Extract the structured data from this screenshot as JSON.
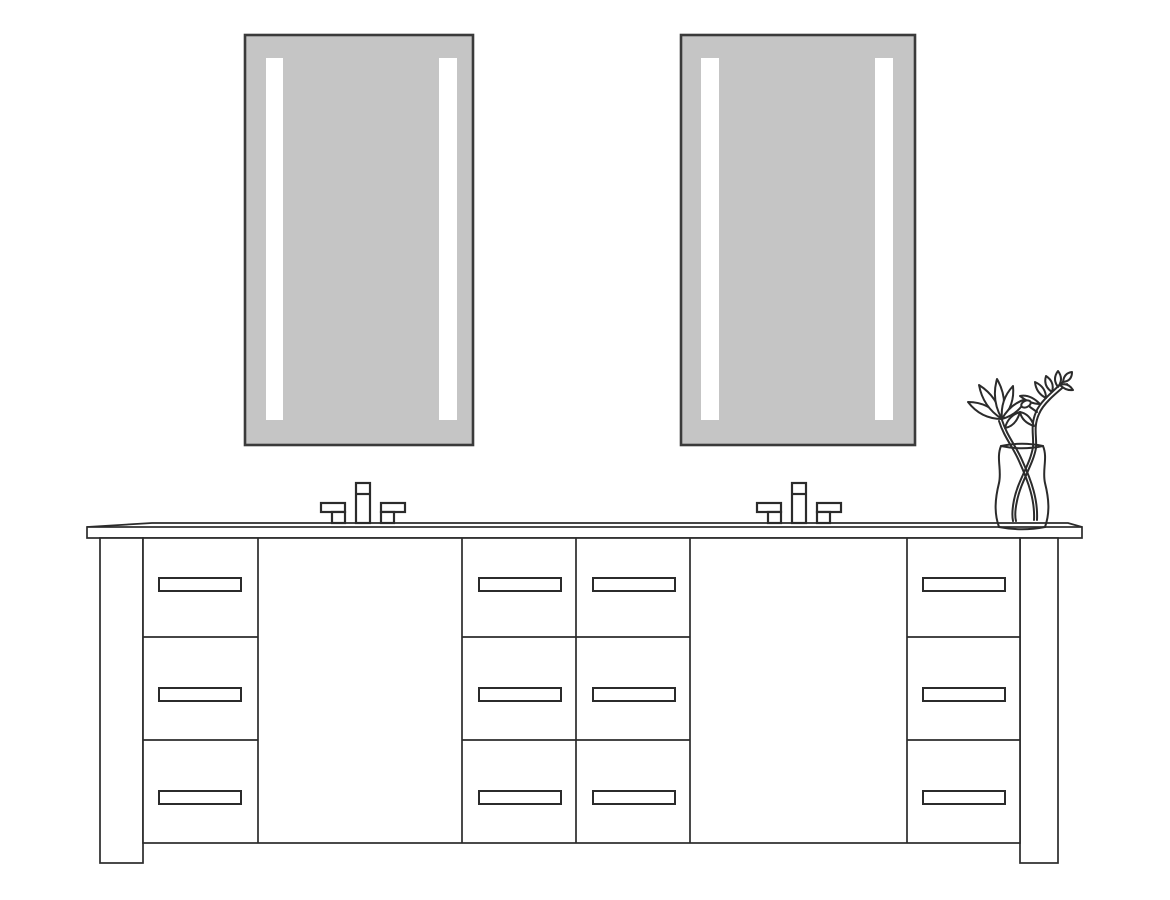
{
  "meta": {
    "title": "Line illustration of a double-sink bathroom vanity with two lighted LED mirrors, two widespread faucets and a flower vase"
  },
  "colors": {
    "background": "#ffffff",
    "line": "#2b2b2b",
    "mirror_fill": "#c5c5c5",
    "mirror_border": "#3a3a3a",
    "led_strip": "#ffffff"
  },
  "scene": {
    "mirrors": {
      "count": 2,
      "led_strips_per_mirror": 2,
      "style": "rectangular, frameless, vertical LED light bars"
    },
    "faucets": {
      "count": 2,
      "handles_per_faucet": 2,
      "style": "widespread two-handle deck-mount"
    },
    "countertop": {
      "count": 1,
      "style": "slab top with beveled top edge"
    },
    "cabinet": {
      "drawer_banks": 4,
      "drawers_per_bank": 3,
      "total_drawers": 12,
      "drawer_pulls": 12,
      "sink_doors": 2,
      "legs": 2
    },
    "decor": {
      "vases": 1,
      "flower_blooms": 1,
      "leafy_branches": 1
    }
  }
}
